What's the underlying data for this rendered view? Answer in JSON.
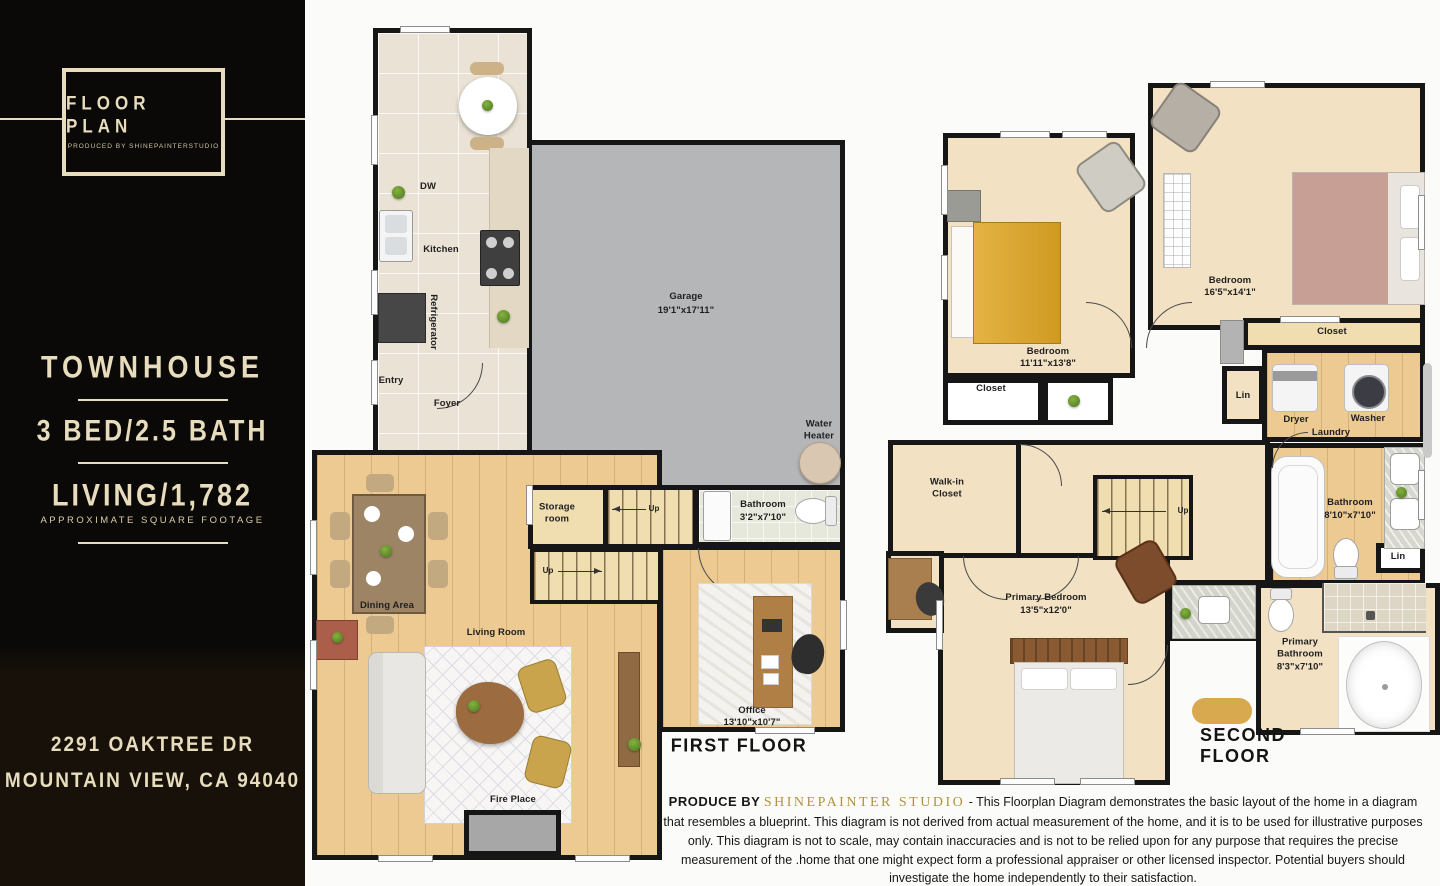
{
  "sidebar": {
    "logo_title": "FLOOR PLAN",
    "logo_subtitle": "PRODUCED BY SHINEPAINTERSTUDIO",
    "property_type": "TOWNHOUSE",
    "beds_baths": "3 BED/2.5 BATH",
    "living": "LIVING/1,782",
    "living_note": "APPROXIMATE SQUARE FOOTAGE",
    "address_line1": "2291 OAKTREE DR",
    "address_line2": "MOUNTAIN VIEW, CA 94040"
  },
  "first_floor": {
    "title": "FIRST FLOOR",
    "labels": {
      "dw": "DW",
      "kitchen": "Kitchen",
      "refrigerator": "Refrigerator",
      "entry": "Entry",
      "foyer": "Foyer",
      "garage_name": "Garage",
      "garage_dim": "19'1\"x17'11\"",
      "water_heater": "Water\nHeater",
      "storage_room": "Storage\nroom",
      "bathroom_name": "Bathroom",
      "bathroom_dim": "3'2\"x7'10\"",
      "up_upper": "Up",
      "up_lower": "Up",
      "dining_area": "Dining Area",
      "living_room": "Living Room",
      "office_name": "Office",
      "office_dim": "13'10\"x10'7\"",
      "fire_place": "Fire Place"
    }
  },
  "second_floor": {
    "title": "SECOND FLOOR",
    "labels": {
      "bedroom_left_name": "Bedroom",
      "bedroom_left_dim": "11'11\"x13'8\"",
      "bedroom_right_name": "Bedroom",
      "bedroom_right_dim": "16'5\"x14'1\"",
      "closet_left": "Closet",
      "closet_right": "Closet",
      "lin_upper": "Lin",
      "dryer": "Dryer",
      "washer": "Washer",
      "laundry": "Laundry",
      "walk_in_closet": "Walk-in\nCloset",
      "up": "Up",
      "bathroom_name": "Bathroom",
      "bathroom_dim": "8'10\"x7'10\"",
      "lin_lower": "Lin",
      "primary_bedroom_name": "Primary Bedroom",
      "primary_bedroom_dim": "13'5\"x12'0\"",
      "primary_bathroom": "Primary\nBathroom\n8'3\"x7'10\""
    }
  },
  "footer": {
    "produce_by": "PRODUCE BY",
    "studio": "SHINEPAINTER STUDIO",
    "disclaimer": "- This Floorplan Diagram demonstrates the basic layout of the home in a diagram that resembles a blueprint. This diagram is not derived from actual measurement of the home, and it is to be used for illustrative purposes only. This diagram is not to scale, may contain inaccuracies and is not to be relied upon for any purpose that requires the precise measurement of the .home that one might expect form a professional appraiser or other licensed inspector. Potential buyers should investigate the home independently to their satisfaction."
  },
  "colors": {
    "accent_cream": "#e7dcbc",
    "studio_gold": "#b2923c",
    "wall_black": "#161616",
    "wood_floor": "#ecca92",
    "tile_floor": "#eae2d4",
    "carpet_floor": "#f2e2c3",
    "garage_gray": "#b5b6b8"
  }
}
